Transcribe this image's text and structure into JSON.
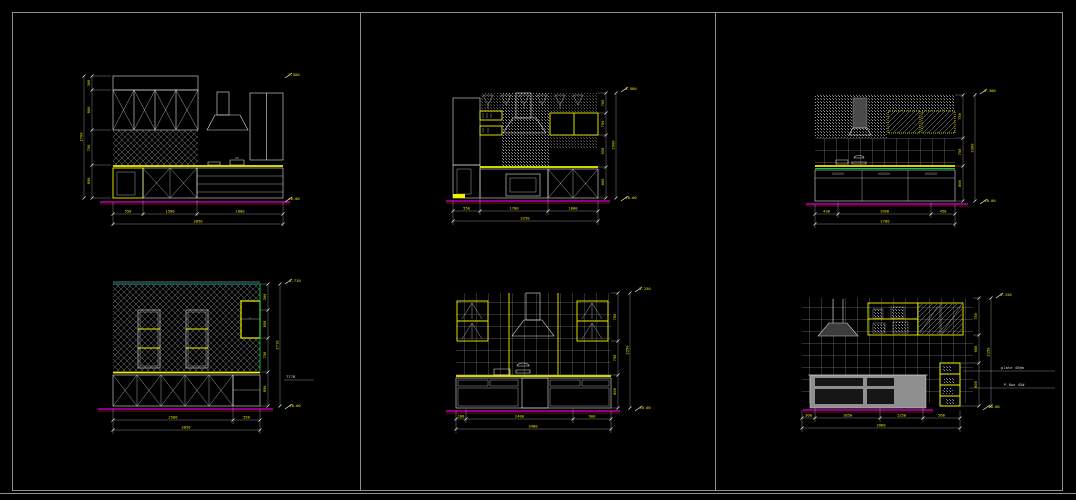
{
  "drawing": {
    "background": "#000000",
    "frame_color": "#8f8f8f",
    "line_color": "#e2e2e2",
    "dimension_color": "#f0e400",
    "counter_color": "#f2f200",
    "floor_line_color": "#dd00dd",
    "accent_green": "#00cc44",
    "accent_cyan": "#00cccc"
  },
  "panels": [
    {
      "id": "kitchen-elevation-top-left",
      "side": [
        "300",
        "800",
        "750",
        "850"
      ],
      "side_total": "2700",
      "bottom": [
        "550",
        "1500",
        "1800"
      ],
      "bottom_total": "3850",
      "marker_top": "2.580",
      "marker_bottom": "±0.00"
    },
    {
      "id": "kitchen-elevation-top-middle",
      "side": [
        "700",
        "750",
        "650",
        "800"
      ],
      "side_total": "2900",
      "bottom": [
        "550",
        "1700",
        "1000"
      ],
      "bottom_total": "3250",
      "marker_top": "2.580",
      "marker_bottom": "±0.00"
    },
    {
      "id": "kitchen-elevation-top-right",
      "side": [
        "750",
        "750",
        "800"
      ],
      "side_total": "2300",
      "bottom": [
        "430",
        "1900",
        "450"
      ],
      "bottom_total": "2780",
      "marker_top": "2.300",
      "marker_bottom": "±0.00"
    },
    {
      "id": "kitchen-elevation-bottom-left",
      "side": [
        "260",
        "850",
        "750",
        "850"
      ],
      "side_total": "2710",
      "bottom": [
        "2500",
        "550"
      ],
      "bottom_total": "3050",
      "marker_top": "2.710",
      "marker_bottom": "±0.00",
      "leader": "7778"
    },
    {
      "id": "kitchen-elevation-bottom-middle",
      "side": [
        "700",
        "750",
        "800"
      ],
      "side_total": "2250",
      "bottom": [
        "180",
        "2400",
        "900"
      ],
      "bottom_total": "3480",
      "marker_top": "2.250",
      "marker_bottom": "±0.00"
    },
    {
      "id": "kitchen-elevation-bottom-right",
      "side": [
        "750",
        "600",
        "800"
      ],
      "side_total": "2150",
      "bottom": [
        "300",
        "1850",
        "1250",
        "560"
      ],
      "bottom_total": "3960",
      "marker_top": "2.150",
      "marker_bottom": "±0.00",
      "notes": [
        "plate 45@m",
        "P.0wx 45#"
      ]
    }
  ]
}
